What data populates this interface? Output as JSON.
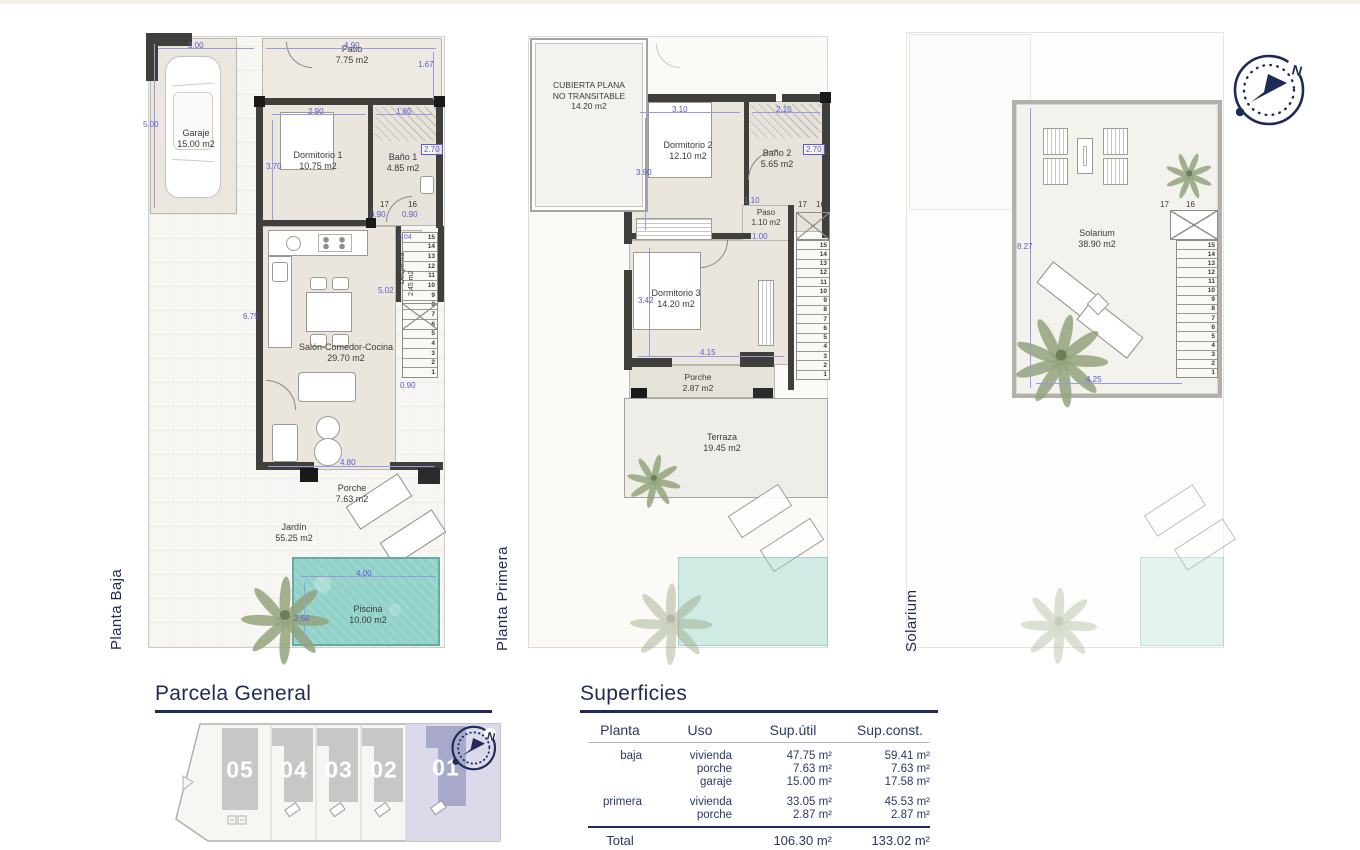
{
  "compass": {
    "north": "N"
  },
  "floors": {
    "baja": {
      "title": "Planta Baja",
      "rooms": {
        "garaje": {
          "name": "Garaje",
          "area": "15.00 m2"
        },
        "patio": {
          "name": "Patio",
          "area": "7.75 m2"
        },
        "dormitorio1": {
          "name": "Dormitorio 1",
          "area": "10.75 m2"
        },
        "bano1": {
          "name": "Baño 1",
          "area": "4.85 m2"
        },
        "despensa": {
          "name": "Despensa",
          "area": "2.45 m2"
        },
        "salon": {
          "name": "Salón-Comedor-Cocina",
          "area": "29.70 m2"
        },
        "porche": {
          "name": "Porche",
          "area": "7.63 m2"
        },
        "jardin": {
          "name": "Jardín",
          "area": "55.25 m2"
        },
        "piscina": {
          "name": "Piscina",
          "area": "10.00 m2"
        }
      },
      "dims": {
        "d300": "3.00",
        "d490": "4.90",
        "d167": "1.67",
        "d500": "5.00",
        "d290": "2.90",
        "d180": "1.80",
        "d370": "3.70",
        "d270": "2.70",
        "s17": "17",
        "s16": "16",
        "d090a": "0.90",
        "d090b": "0.90",
        "d304": "3.04",
        "d502": "5.02",
        "d675": "6.75",
        "d480": "4.80",
        "d090c": "0.90",
        "d400": "4.00",
        "d250": "2.50"
      },
      "stairs": [
        "15",
        "14",
        "13",
        "12",
        "11",
        "10",
        "9",
        "8",
        "7",
        "6",
        "5",
        "4",
        "3",
        "2",
        "1"
      ]
    },
    "primera": {
      "title": "Planta Primera",
      "rooms": {
        "cubierta": {
          "name": "CUBIERTA PLANA NO TRANSITABLE",
          "area": "14.20 m2"
        },
        "dormitorio2": {
          "name": "Dormitorio 2",
          "area": "12.10 m2"
        },
        "bano2": {
          "name": "Baño 2",
          "area": "5.65 m2"
        },
        "paso": {
          "name": "Paso",
          "area": "1.10 m2"
        },
        "dormitorio3": {
          "name": "Dormitorio 3",
          "area": "14.20 m2"
        },
        "porche": {
          "name": "Porche",
          "area": "2.87 m2"
        },
        "terraza": {
          "name": "Terraza",
          "area": "19.45 m2"
        }
      },
      "dims": {
        "d310": "3.10",
        "d210": "2.10",
        "d390": "3.90",
        "d270": "2.70",
        "d110": "1.10",
        "d100": "1.00",
        "d342": "3.42",
        "d415": "4.15",
        "s17": "17",
        "s16": "16"
      },
      "stairs": [
        "15",
        "14",
        "13",
        "12",
        "11",
        "10",
        "9",
        "8",
        "7",
        "6",
        "5",
        "4",
        "3",
        "2",
        "1"
      ]
    },
    "solarium": {
      "title": "Solarium",
      "rooms": {
        "solarium": {
          "name": "Solarium",
          "area": "38.90 m2"
        }
      },
      "dims": {
        "d827": "8.27",
        "d425": "4.25",
        "s17": "17",
        "s16": "16"
      },
      "stairs": [
        "15",
        "14",
        "13",
        "12",
        "11",
        "10",
        "9",
        "8",
        "7",
        "6",
        "5",
        "4",
        "3",
        "2",
        "1"
      ]
    }
  },
  "parcela": {
    "title": "Parcela General",
    "plots": [
      {
        "label": "05"
      },
      {
        "label": "04"
      },
      {
        "label": "03"
      },
      {
        "label": "02"
      },
      {
        "label": "01"
      }
    ],
    "highlight_color": "#a8a8cb"
  },
  "superficies": {
    "title": "Superficies",
    "columns": {
      "planta": "Planta",
      "uso": "Uso",
      "util": "Sup.útil",
      "const": "Sup.const."
    },
    "groups": [
      {
        "planta": "baja",
        "rows": [
          {
            "uso": "vivienda",
            "util": "47.75 m²",
            "const": "59.41 m²"
          },
          {
            "uso": "porche",
            "util": "7.63 m²",
            "const": "7.63 m²"
          },
          {
            "uso": "garaje",
            "util": "15.00 m²",
            "const": "17.58 m²"
          }
        ]
      },
      {
        "planta": "primera",
        "rows": [
          {
            "uso": "vivienda",
            "util": "33.05 m²",
            "const": "45.53 m²"
          },
          {
            "uso": "porche",
            "util": "2.87 m²",
            "const": "2.87 m²"
          }
        ]
      }
    ],
    "total": {
      "label": "Total",
      "util": "106.30 m²",
      "const": "133.02 m²"
    }
  },
  "colors": {
    "navy": "#1d2b56",
    "dim_blue": "#5b5bd0",
    "pool": "#90d1c8",
    "wall": "#413f3b"
  }
}
